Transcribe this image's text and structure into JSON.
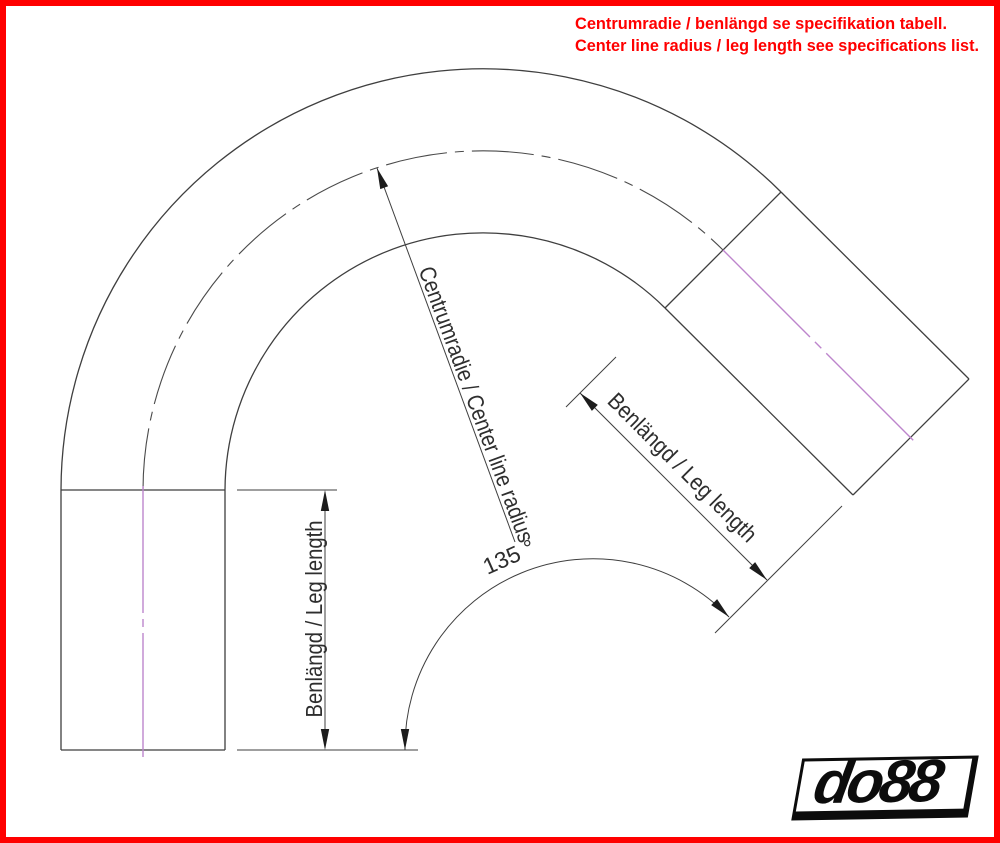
{
  "notice": {
    "line1": "Centrumradie / benlängd se specifikation tabell.",
    "line2": "Center line radius / leg length see specifications list."
  },
  "dimensions": {
    "center_radius_label": "Centrumradie / Center line radius",
    "angle_label": "135 °",
    "left_leg_label": "Benlängd / Leg length",
    "right_leg_label": "Benlängd / Leg length"
  },
  "logo": {
    "text": "do88"
  },
  "colors": {
    "frame": "#ff0000",
    "notice": "#ff0000",
    "drawing_line": "#3f3f3f",
    "dimension_line": "#3f3f3f",
    "dimension_text": "#2e2e2e",
    "centerline_arc": "#4a4a4a",
    "centerline_magenta": "#bd85cc",
    "arrow_fill": "#1c1c1c",
    "logo_black": "#0c0c0c"
  }
}
